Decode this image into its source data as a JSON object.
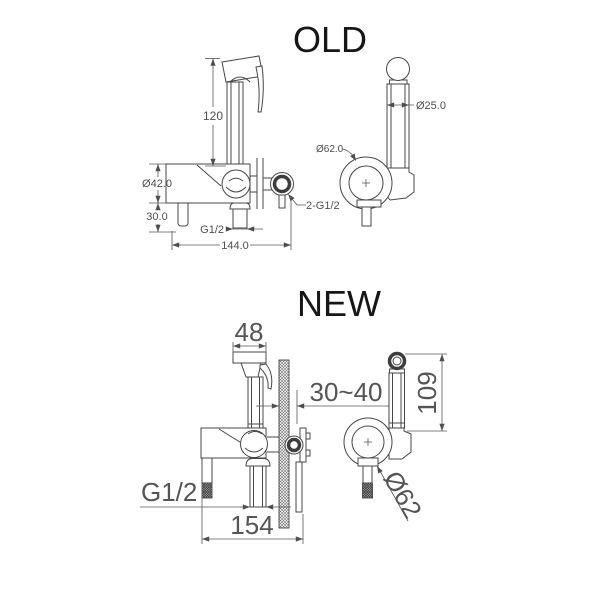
{
  "old": {
    "title": "OLD",
    "front": {
      "hose_height": "120",
      "body_diameter": "Ø42.0",
      "handle_drop": "30.0",
      "outlet_thread": "G1/2",
      "overall_width": "144.0",
      "inlet_threads": "2-G1/2"
    },
    "side": {
      "sprayer_diameter": "Ø25.0",
      "holder_diameter": "Ø62.0"
    }
  },
  "new": {
    "title": "NEW",
    "front": {
      "head_width": "48",
      "wall_depth": "30~40",
      "outlet_thread": "G1/2",
      "overall_width": "154"
    },
    "side": {
      "sprayer_height": "109",
      "holder_diameter": "Ø62"
    }
  }
}
